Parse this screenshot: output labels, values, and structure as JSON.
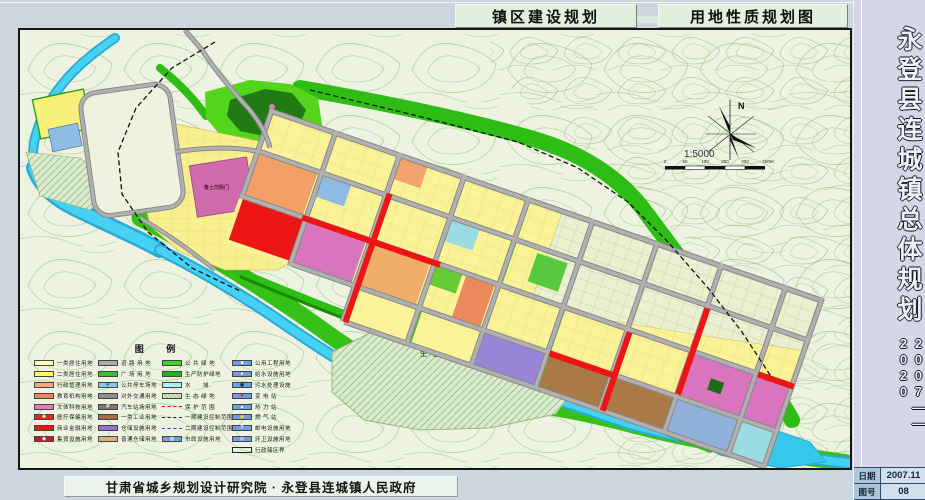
{
  "titles": {
    "left": "镇区建设规划",
    "right": "用地性质规划图"
  },
  "sidebar": {
    "title": "永登县连城镇总体规划",
    "period": "2007——2020",
    "date_label": "日期",
    "date_value": "2007.11",
    "sheet_no_label": "图号",
    "sheet_no_value": "08"
  },
  "footer": {
    "credit": "甘肃省城乡规划设计研究院 · 永登县连城镇人民政府"
  },
  "map": {
    "north_label": "N",
    "scale_text": "1:5000",
    "scale_ticks": [
      "0",
      "50",
      "100",
      "200",
      "300",
      "400M"
    ],
    "labels": {
      "heritage_site": "鲁土司衙门",
      "eco_green": "生态绿地"
    }
  },
  "palette": {
    "residential_1": "#ffffb2",
    "residential_2": "#ffff55",
    "admin": "#f6a97c",
    "education": "#ef8656",
    "culture": "#e77cba",
    "medical": "#e62525",
    "commercial": "#f21313",
    "market": "#c41d1d",
    "road": "#a9a9a9",
    "plaza": "#2fc32f",
    "parking": "#8ec7e9",
    "industry_1": "#a56b3d",
    "warehouse": "#8f74d2",
    "storage": "#d9b274",
    "public_green": "#3ed225",
    "protect_green": "#18ba18",
    "water": "#35c8ea",
    "utility_blue": "#6f9ede",
    "terrain": "#edf2e1",
    "contour": "#a9ce8f"
  },
  "legend": {
    "title": "图 例",
    "columns": [
      [
        {
          "label": "一类居住用地",
          "sw": {
            "type": "fill",
            "fill": "#ffffb2"
          }
        },
        {
          "label": "二类居住用地",
          "sw": {
            "type": "fill",
            "fill": "#ffff55"
          }
        },
        {
          "label": "行政管理用地",
          "sw": {
            "type": "fill",
            "fill": "#f6a97c"
          }
        },
        {
          "label": "教育机构用地",
          "sw": {
            "type": "fill",
            "fill": "#ef8656"
          }
        },
        {
          "label": "文体科技用地",
          "sw": {
            "type": "fill",
            "fill": "#e77cba"
          }
        },
        {
          "label": "医疗保健用地",
          "sw": {
            "type": "fill",
            "fill": "#e62525",
            "glyph": "✚",
            "gc": "#ffffff"
          }
        },
        {
          "label": "商业金融用地",
          "sw": {
            "type": "fill",
            "fill": "#f21313"
          }
        },
        {
          "label": "集贸设施用地",
          "sw": {
            "type": "fill",
            "fill": "#c41d1d",
            "glyph": "◆",
            "gc": "#ffffff"
          }
        }
      ],
      [
        {
          "label": "道 路 用 地",
          "sw": {
            "type": "fill",
            "fill": "#a9a9a9"
          }
        },
        {
          "label": "广 场 用 地",
          "sw": {
            "type": "fill",
            "fill": "#2fc32f"
          }
        },
        {
          "label": "公共停车场地",
          "sw": {
            "type": "fill",
            "fill": "#8ec7e9",
            "glyph": "P",
            "gc": "#13427c"
          }
        },
        {
          "label": "对外交通用地",
          "sw": {
            "type": "fill",
            "fill": "#8f8f8f"
          }
        },
        {
          "label": "汽车站场用地",
          "sw": {
            "type": "fill",
            "fill": "#787878",
            "glyph": "P",
            "gc": "#ffffff"
          }
        },
        {
          "label": "一类工业用地",
          "sw": {
            "type": "fill",
            "fill": "#a56b3d"
          }
        },
        {
          "label": "仓储设施用地",
          "sw": {
            "type": "fill",
            "fill": "#8f74d2"
          }
        },
        {
          "label": "普通仓储用地",
          "sw": {
            "type": "fill",
            "fill": "#d9b274"
          }
        }
      ],
      [
        {
          "label": "公 共 绿 地",
          "sw": {
            "type": "fill",
            "fill": "#3ed225"
          }
        },
        {
          "label": "生产防护绿地",
          "sw": {
            "type": "fill",
            "fill": "#18ba18"
          }
        },
        {
          "label": "水　　域",
          "sw": {
            "type": "fill",
            "fill": "#aeeef6"
          }
        },
        {
          "label": "生 态 绿 地",
          "sw": {
            "type": "hatch",
            "fill": "#dcead0"
          }
        },
        {
          "label": "保 护 范 围",
          "sw": {
            "type": "dash",
            "line": "#e01010"
          }
        },
        {
          "label": "一期建设控制范围",
          "sw": {
            "type": "dash",
            "line": "#222222"
          }
        },
        {
          "label": "二期建设控制范围",
          "sw": {
            "type": "dash",
            "line": "#2255cc"
          }
        },
        {
          "label": "市政设施用地",
          "sw": {
            "type": "fill",
            "fill": "#6f9ede",
            "glyph": "◎",
            "gc": "#ffffff"
          }
        }
      ],
      [
        {
          "label": "公用工程用地",
          "sw": {
            "type": "fill",
            "fill": "#6f9ede",
            "glyph": "■",
            "gc": "#ffffff"
          }
        },
        {
          "label": "给水设施用地",
          "sw": {
            "type": "fill",
            "fill": "#6f9ede",
            "glyph": "●",
            "gc": "#ffffff"
          }
        },
        {
          "label": "污水处理设施",
          "sw": {
            "type": "fill",
            "fill": "#6f9ede",
            "glyph": "◉",
            "gc": "#0a2a5a"
          }
        },
        {
          "label": "变 电 站",
          "sw": {
            "type": "fill",
            "fill": "#6f9ede",
            "glyph": "✦",
            "gc": "#d01010"
          }
        },
        {
          "label": "热 力 站",
          "sw": {
            "type": "fill",
            "fill": "#6f9ede",
            "glyph": "▲",
            "gc": "#ffffff"
          }
        },
        {
          "label": "燃 气 站",
          "sw": {
            "type": "fill",
            "fill": "#6f9ede",
            "glyph": "◆",
            "gc": "#ffd400"
          }
        },
        {
          "label": "邮电设施用地",
          "sw": {
            "type": "fill",
            "fill": "#6f9ede",
            "glyph": "T",
            "gc": "#ffffff"
          }
        },
        {
          "label": "环卫设施用地",
          "sw": {
            "type": "fill",
            "fill": "#6f9ede",
            "glyph": "◇",
            "gc": "#ffffff"
          }
        },
        {
          "label": "行政辖区界",
          "sw": {
            "type": "outline"
          }
        }
      ]
    ]
  }
}
